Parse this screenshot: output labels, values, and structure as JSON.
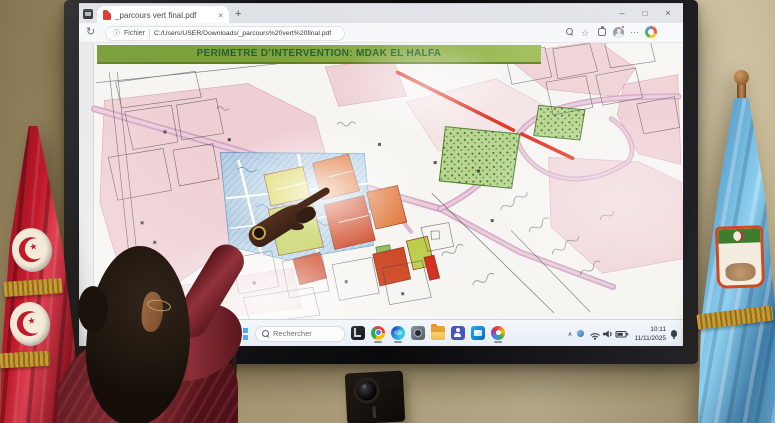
{
  "window": {
    "tab_title": "_parcours vert final.pdf",
    "controls": {
      "minimize": "–",
      "maximize": "□",
      "close": "×"
    }
  },
  "browser": {
    "new_tab": "+",
    "tab_close": "×",
    "address": {
      "label": "Fichier",
      "url": "C:/Users/USER/Downloads/_parcours%20vert%20final.pdf"
    },
    "toolbar_glyphs": {
      "reload": "↻",
      "info": "ⓘ",
      "star": "☆",
      "more": "…"
    }
  },
  "pdf": {
    "banner_title": "PERIMETRE D’INTERVENTION: MDAK EL HALFA"
  },
  "taskbar": {
    "search_placeholder": "Rechercher",
    "tray_chevron": "∧",
    "clock_time": "10:11",
    "clock_date": "11/11/2025",
    "apps": [
      "dark-app",
      "chrome",
      "edge",
      "camera",
      "file-explorer",
      "teams",
      "outlook",
      "colorful-app"
    ],
    "tray_icons": [
      "tray-chevron",
      "status",
      "wifi",
      "volume",
      "battery",
      "notification-bell"
    ]
  },
  "colors": {
    "wall": "#c7b58c",
    "tabstrip_bg": "#dee1e6",
    "toolbar_bg": "#f7f8fa",
    "taskbar_bg": "#e8eef6",
    "banner_bg": "#7fa33a",
    "banner_text": "#1d5e2d",
    "map_pink": "#eec9cf",
    "map_road_pink": "#cf9fbd",
    "map_red": "#df3425",
    "map_blue": "#a9cfe7",
    "map_park": "#b9d58f",
    "map_yellow": "#d8d44c",
    "map_olive": "#bccd4b",
    "map_orange": "#df7030",
    "map_deep_orange": "#cd4420",
    "tunisia_red": "#c11a2b",
    "flag_blue": "#6cb2d9",
    "fringe_gold": "#c79a33",
    "sweater": "#7c2730",
    "skin": "#3a2117"
  }
}
